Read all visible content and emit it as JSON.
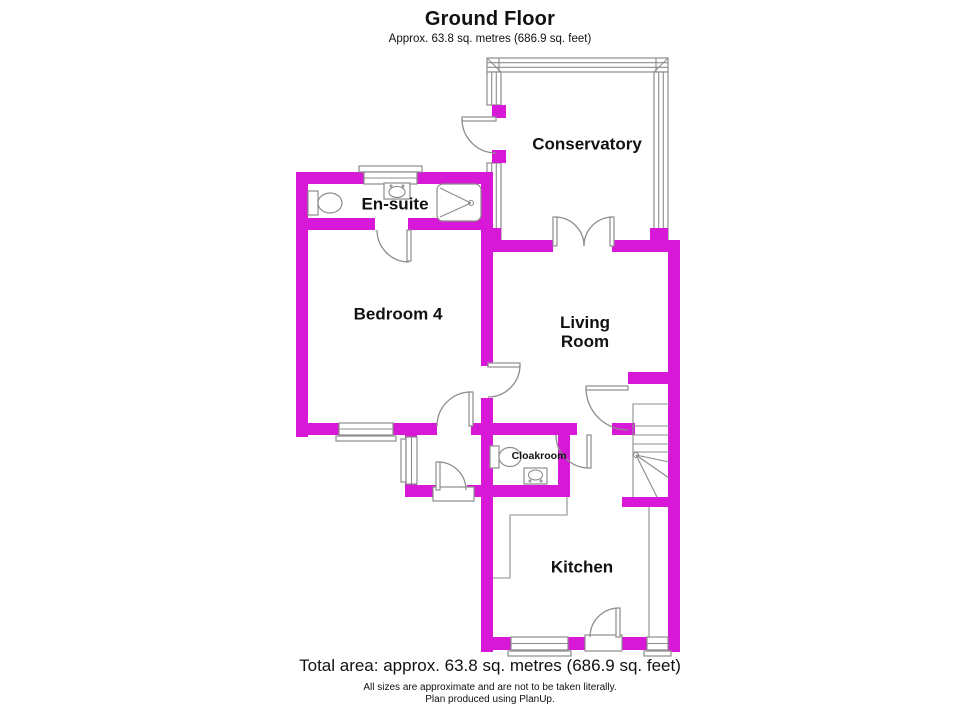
{
  "header": {
    "title": "Ground Floor",
    "subtitle": "Approx. 63.8 sq. metres (686.9 sq. feet)"
  },
  "rooms": [
    {
      "id": "conservatory",
      "label": "Conservatory"
    },
    {
      "id": "ensuite",
      "label": "En-suite"
    },
    {
      "id": "bedroom4",
      "label": "Bedroom 4"
    },
    {
      "id": "living",
      "label": "Living Room"
    },
    {
      "id": "cloakroom",
      "label": "Cloakroom"
    },
    {
      "id": "kitchen",
      "label": "Kitchen"
    }
  ],
  "fixtures": [
    {
      "room": "En-suite",
      "items": [
        "toilet",
        "wash-basin",
        "shower"
      ]
    },
    {
      "room": "Cloakroom",
      "items": [
        "toilet",
        "wash-basin"
      ]
    },
    {
      "room": "Kitchen",
      "items": [
        "worktop-counter"
      ]
    },
    {
      "room": "Hall",
      "items": [
        "staircase"
      ]
    }
  ],
  "footer": {
    "total": "Total area: approx. 63.8 sq. metres (686.9 sq. feet)",
    "disclaimer": "All sizes are approximate and are not to be taken literally.",
    "credit": "Plan produced using PlanUp."
  },
  "colors": {
    "wall": "#d718d7",
    "line": "#8c8c8c",
    "text": "#111111"
  }
}
